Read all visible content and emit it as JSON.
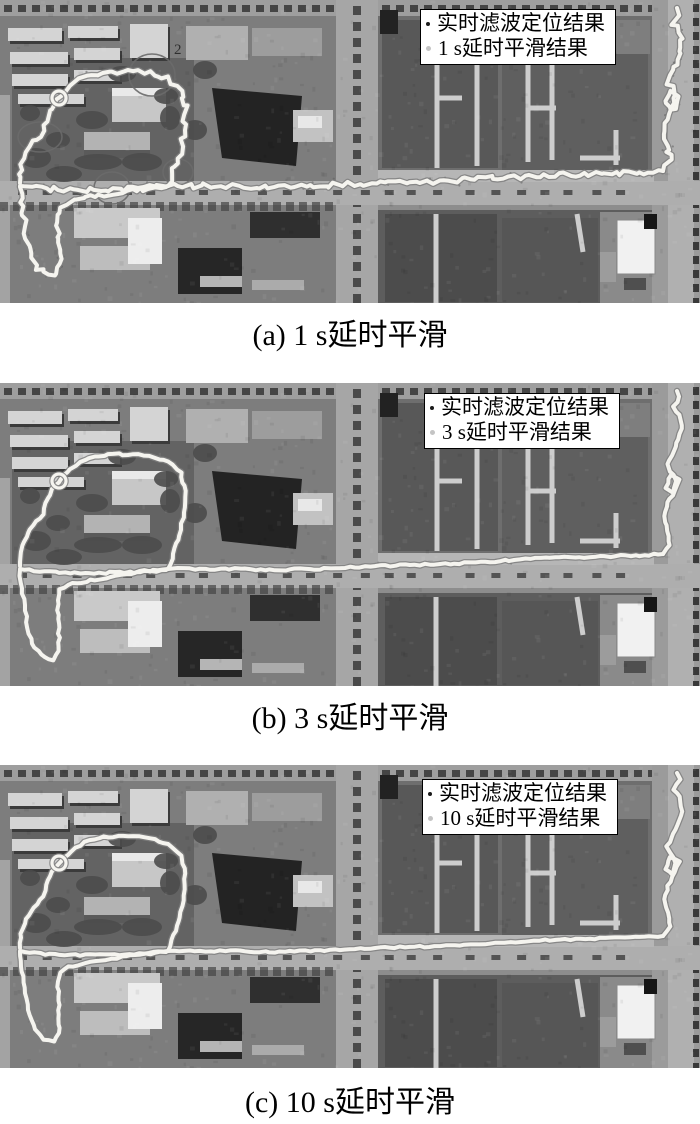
{
  "figure": {
    "type": "satellite-trajectory-comparison",
    "trajectory_color": "#f5f4ef",
    "legend_background": "#ffffff",
    "legend_border": "#000000",
    "panels": [
      {
        "id": "a",
        "caption": "(a) 1 s延时平滑",
        "map_label": "2",
        "legend": {
          "items": [
            {
              "marker": "dot",
              "marker_color": "#1a1a1a",
              "label": "实时滤波定位结果"
            },
            {
              "marker": "dot",
              "marker_color": "#c4c4c4",
              "label": "1 s延时平滑结果"
            }
          ]
        }
      },
      {
        "id": "b",
        "caption": "(b) 3 s延时平滑",
        "map_label": "",
        "legend": {
          "items": [
            {
              "marker": "dot",
              "marker_color": "#1a1a1a",
              "label": "实时滤波定位结果"
            },
            {
              "marker": "dot",
              "marker_color": "#c4c4c4",
              "label": "3 s延时平滑结果"
            }
          ]
        }
      },
      {
        "id": "c",
        "caption": "(c) 10 s延时平滑",
        "map_label": "",
        "legend": {
          "items": [
            {
              "marker": "dot",
              "marker_color": "#1a1a1a",
              "label": "实时滤波定位结果"
            },
            {
              "marker": "dot",
              "marker_color": "#c4c4c4",
              "label": "10 s延时平滑结果"
            }
          ]
        }
      }
    ]
  }
}
